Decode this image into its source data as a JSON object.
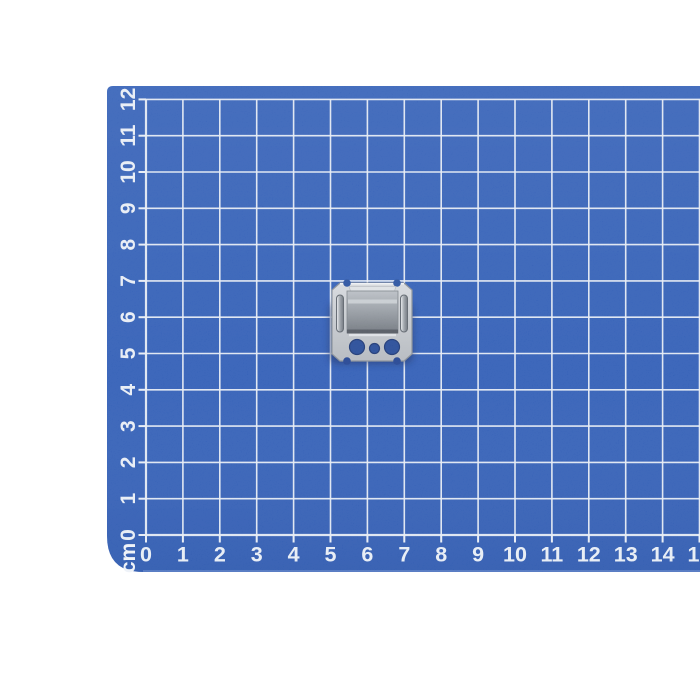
{
  "scene": {
    "description": "Product photo: small galvanized steel mounting clip lying on a blue cutting mat printed with a white centimeter grid, white background",
    "background_color": "#ffffff"
  },
  "mat": {
    "color": "#2d5bb5",
    "grid_line_color": "#e8edf5",
    "label_color": "#eef2f8",
    "unit_label": "cm",
    "x_axis_labels": [
      "0",
      "1",
      "2",
      "3",
      "4",
      "5",
      "6",
      "7",
      "8",
      "9",
      "10",
      "11",
      "12",
      "13",
      "14",
      "15"
    ],
    "y_axis_labels": [
      "0",
      "1",
      "2",
      "3",
      "4",
      "5",
      "6",
      "7",
      "8",
      "9",
      "10",
      "11",
      "12"
    ]
  },
  "object": {
    "name": "metal mounting clip",
    "appearance": "square zinc-plated steel clip with a raised rectangular box, two vertical side slots, three round holes and notched corners",
    "grid_span_cm": "about 2 x 2"
  }
}
